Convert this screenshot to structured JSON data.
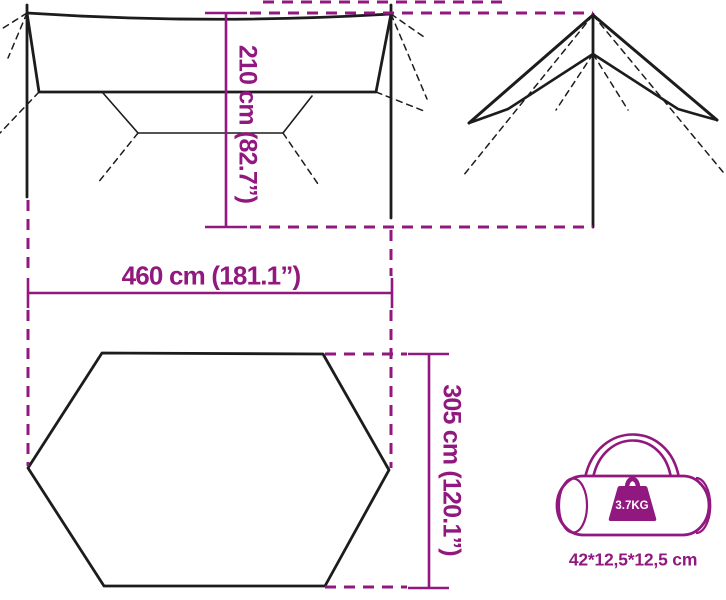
{
  "colors": {
    "accent": "#91187E",
    "ink": "#1c1c1c",
    "background": "#ffffff",
    "weight_text": "#ffffff"
  },
  "labels": {
    "height": "210 cm (82.7”)",
    "width": "460 cm (181.1”)",
    "depth": "305 cm (120.1”)",
    "bag_size": "42*12,5*12,5 cm",
    "bag_weight": "3.7KG"
  }
}
